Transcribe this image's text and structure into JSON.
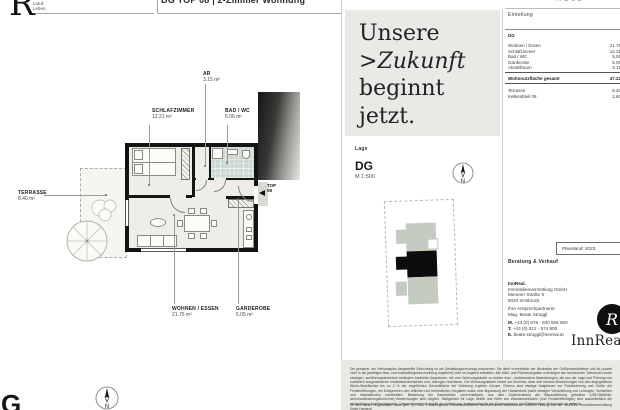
{
  "brand": {
    "letter": "R",
    "tagline1": "Land.",
    "tagline2": "Leben."
  },
  "title_bar": {
    "title": "DG TOP 08 | 2-Zimmer Wohnung"
  },
  "project_header": {
    "name_fragment": "HOLZ"
  },
  "floorplan": {
    "labels": {
      "ar": {
        "name": "AR",
        "area": "3.15 m²"
      },
      "schlafzimmer": {
        "name": "SCHLAFZIMMER",
        "area": "12.21 m²"
      },
      "bad": {
        "name": "BAD / WC",
        "area": "5.06 m²"
      },
      "terrasse": {
        "name": "TERRASSE",
        "area": "8.40 m²"
      },
      "wohnen": {
        "name": "WOHNEN / ESSEN",
        "area": "21.75 m²"
      },
      "garderobe": {
        "name": "GARDEROBE",
        "area": "5.05 m²"
      }
    },
    "entry": {
      "line1": "TOP",
      "line2": "08"
    },
    "corner_letter": "G"
  },
  "slogan": {
    "word1": "Unsere",
    "chevron": ">",
    "word2": "Zukunft",
    "word3": "beginnt",
    "word4": "jetzt."
  },
  "lage": {
    "heading": "Lage",
    "floor": "DG",
    "scale": "M 1:500"
  },
  "einteilung": {
    "heading": "Einteilung",
    "group": "DG",
    "rows": [
      {
        "label": "Wohnen / Essen",
        "value": "21.75"
      },
      {
        "label": "Schlafzimmer",
        "value": "12.21"
      },
      {
        "label": "Bad / WC",
        "value": "5.06"
      },
      {
        "label": "Garderobe",
        "value": "5.05"
      },
      {
        "label": "Abstellraum",
        "value": "3.15"
      }
    ],
    "total": {
      "label": "Wohnnutzfläche gesamt",
      "value": "47.22"
    },
    "extras": [
      {
        "label": "Terrasse",
        "value": "8.40"
      },
      {
        "label": "Kellerabteil 08",
        "value": "2.60"
      }
    ]
  },
  "sales": {
    "planstand": "Planstand: 2023",
    "heading": "Beratung & Verkauf",
    "company_bold": "InnReal.",
    "company": "Immobilienvermittlung GmbH",
    "street": "Meraner Straße 9",
    "city": "6020 Innsbruck",
    "intro": "Ihre Ansprechpartnerin:",
    "person": "Mag. Beate Struggl",
    "m_label": "M.",
    "mobile": "+43 (0) 676 - 840 505 660",
    "t_label": "T.",
    "phone": "+43 (0) 512 - 574 800",
    "e_label": "E.",
    "email": "beate.struggl@innreal.at",
    "logo_letter": "R",
    "logo_wordmark": "InnReal"
  },
  "disclaimer": {
    "para1": "Die gesamte, am Verkaufsplan dargestellte Einrichtung ist als Gestaltungsvorschlag anzusehen. Sie dient vornehmlich der Illustration der Größenverhältnisse und ist (soweit nicht in der jeweiligen Bau- und Ausstattungsbeschreibung angeführt) nicht im Angebot enthalten. Alle Maß- und Flächenangaben unterliegen den technischen Toleranzen sowie etwaigen, ausführungstechnisch bedingten baulichen Adaptionen, die vom Wohnungskäufer zu dulden sind – insbesondere Abweichungen, die aus der Lage und Führung von zusätzlich ausgewiesenen Installationsschächten und -leitungen resultieren. Der Wohnungskäufer nimmt zur Kenntnis, dass sich hieraus Abweichungen von den angegebenen Wohn-/Nutzflächen bis zu 3 % der angeführten Gesamtfläche der Wohnung ergeben können. Ebenso sind etwaige Adaptionen zur Positionierung und Größe der Fensteröffnungen, ein Entsprechen den örtlichen und behördlichen Vorgaben sowie eine Anpassung der Haustechnik (samt etwaiger Verschiebung von Leitungen, Schächten und Installationen) vorbehalten. Beachtung der Raumhöhen: unvermeidbare, aus dem Zwischenstand der Bauausführung gebotene (OIB-Richtlinie, wohnbauförderungskonforme) Abweichungen sind möglich. Maßgeblich für Lage, Breite und Höhe von Wandanschlüssen (und Fensteröffnungen) sind ausschließlich die verbindlichen Ausführungspläne. Dementsprechend sind für die Anfertigung, insbesondere für die Küchenplanung und Einbaumöbel, Naturmaße zu nehmen.",
    "para2": "Es wird darauf hingewiesen, dass gem. § 9 Abs. 4 Maklergesetz ein wirtschaftliches Naheverhältnis zwischen der KAMOS Holding und der INNREAL Immobilienvermittlung GmbH besteht."
  }
}
